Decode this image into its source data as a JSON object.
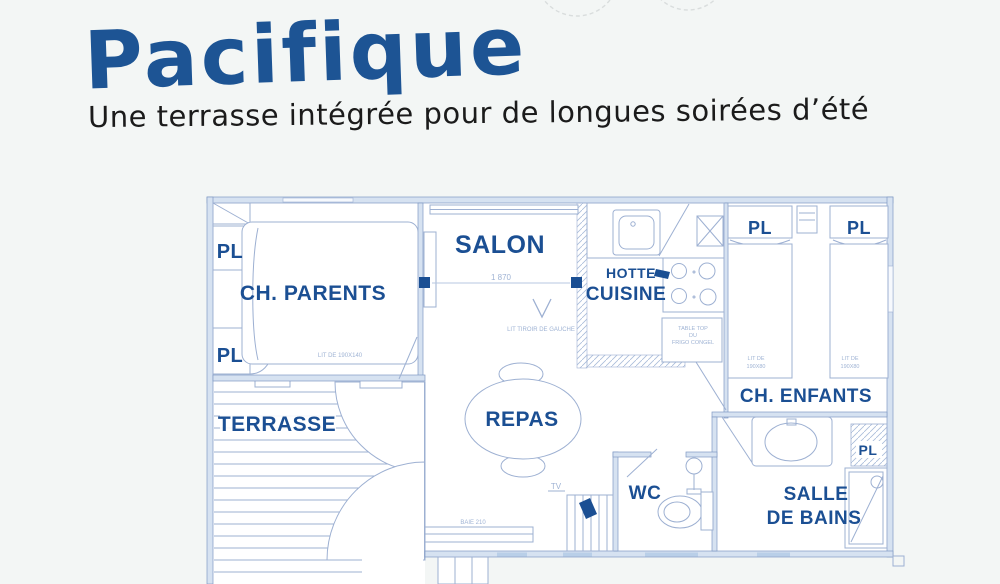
{
  "header": {
    "title": "Pacifique",
    "subtitle": "Une terrasse intégrée pour de longues soirées d’été"
  },
  "colors": {
    "background": "#f3f6f5",
    "title_blue": "#1d5494",
    "subtitle_black": "#1b1b1b",
    "label_blue": "#1b4f93",
    "wall_stroke": "#7f99c4",
    "wall_fill": "#d6e2f1",
    "line": "#9db0d2",
    "tiny_blue": "#9fb3d4",
    "window_fill": "#b9cfe8"
  },
  "floorplan": {
    "labels": {
      "pl": "PL",
      "ch_parents": "CH. PARENTS",
      "salon": "SALON",
      "hotte": "HOTTE",
      "cuisine": "CUISINE",
      "ch_enfants": "CH. ENFANTS",
      "terrasse": "TERRASSE",
      "repas": "REPAS",
      "wc": "WC",
      "salle": "SALLE",
      "de_bains": "DE BAINS"
    },
    "annotations": {
      "dim_salon": "1 870",
      "lit_tiroir": "LIT TIROIR DE GAUCHE",
      "lit_parents": "LIT DE 190X140",
      "lit_enfants_line1": "LIT DE",
      "lit_enfants_line2": "190X80",
      "frigo_line1": "TABLE TOP",
      "frigo_line2": "DU",
      "frigo_line3": "FRIGO CONGEL",
      "tv": "TV",
      "baie": "BAIE 210"
    }
  }
}
